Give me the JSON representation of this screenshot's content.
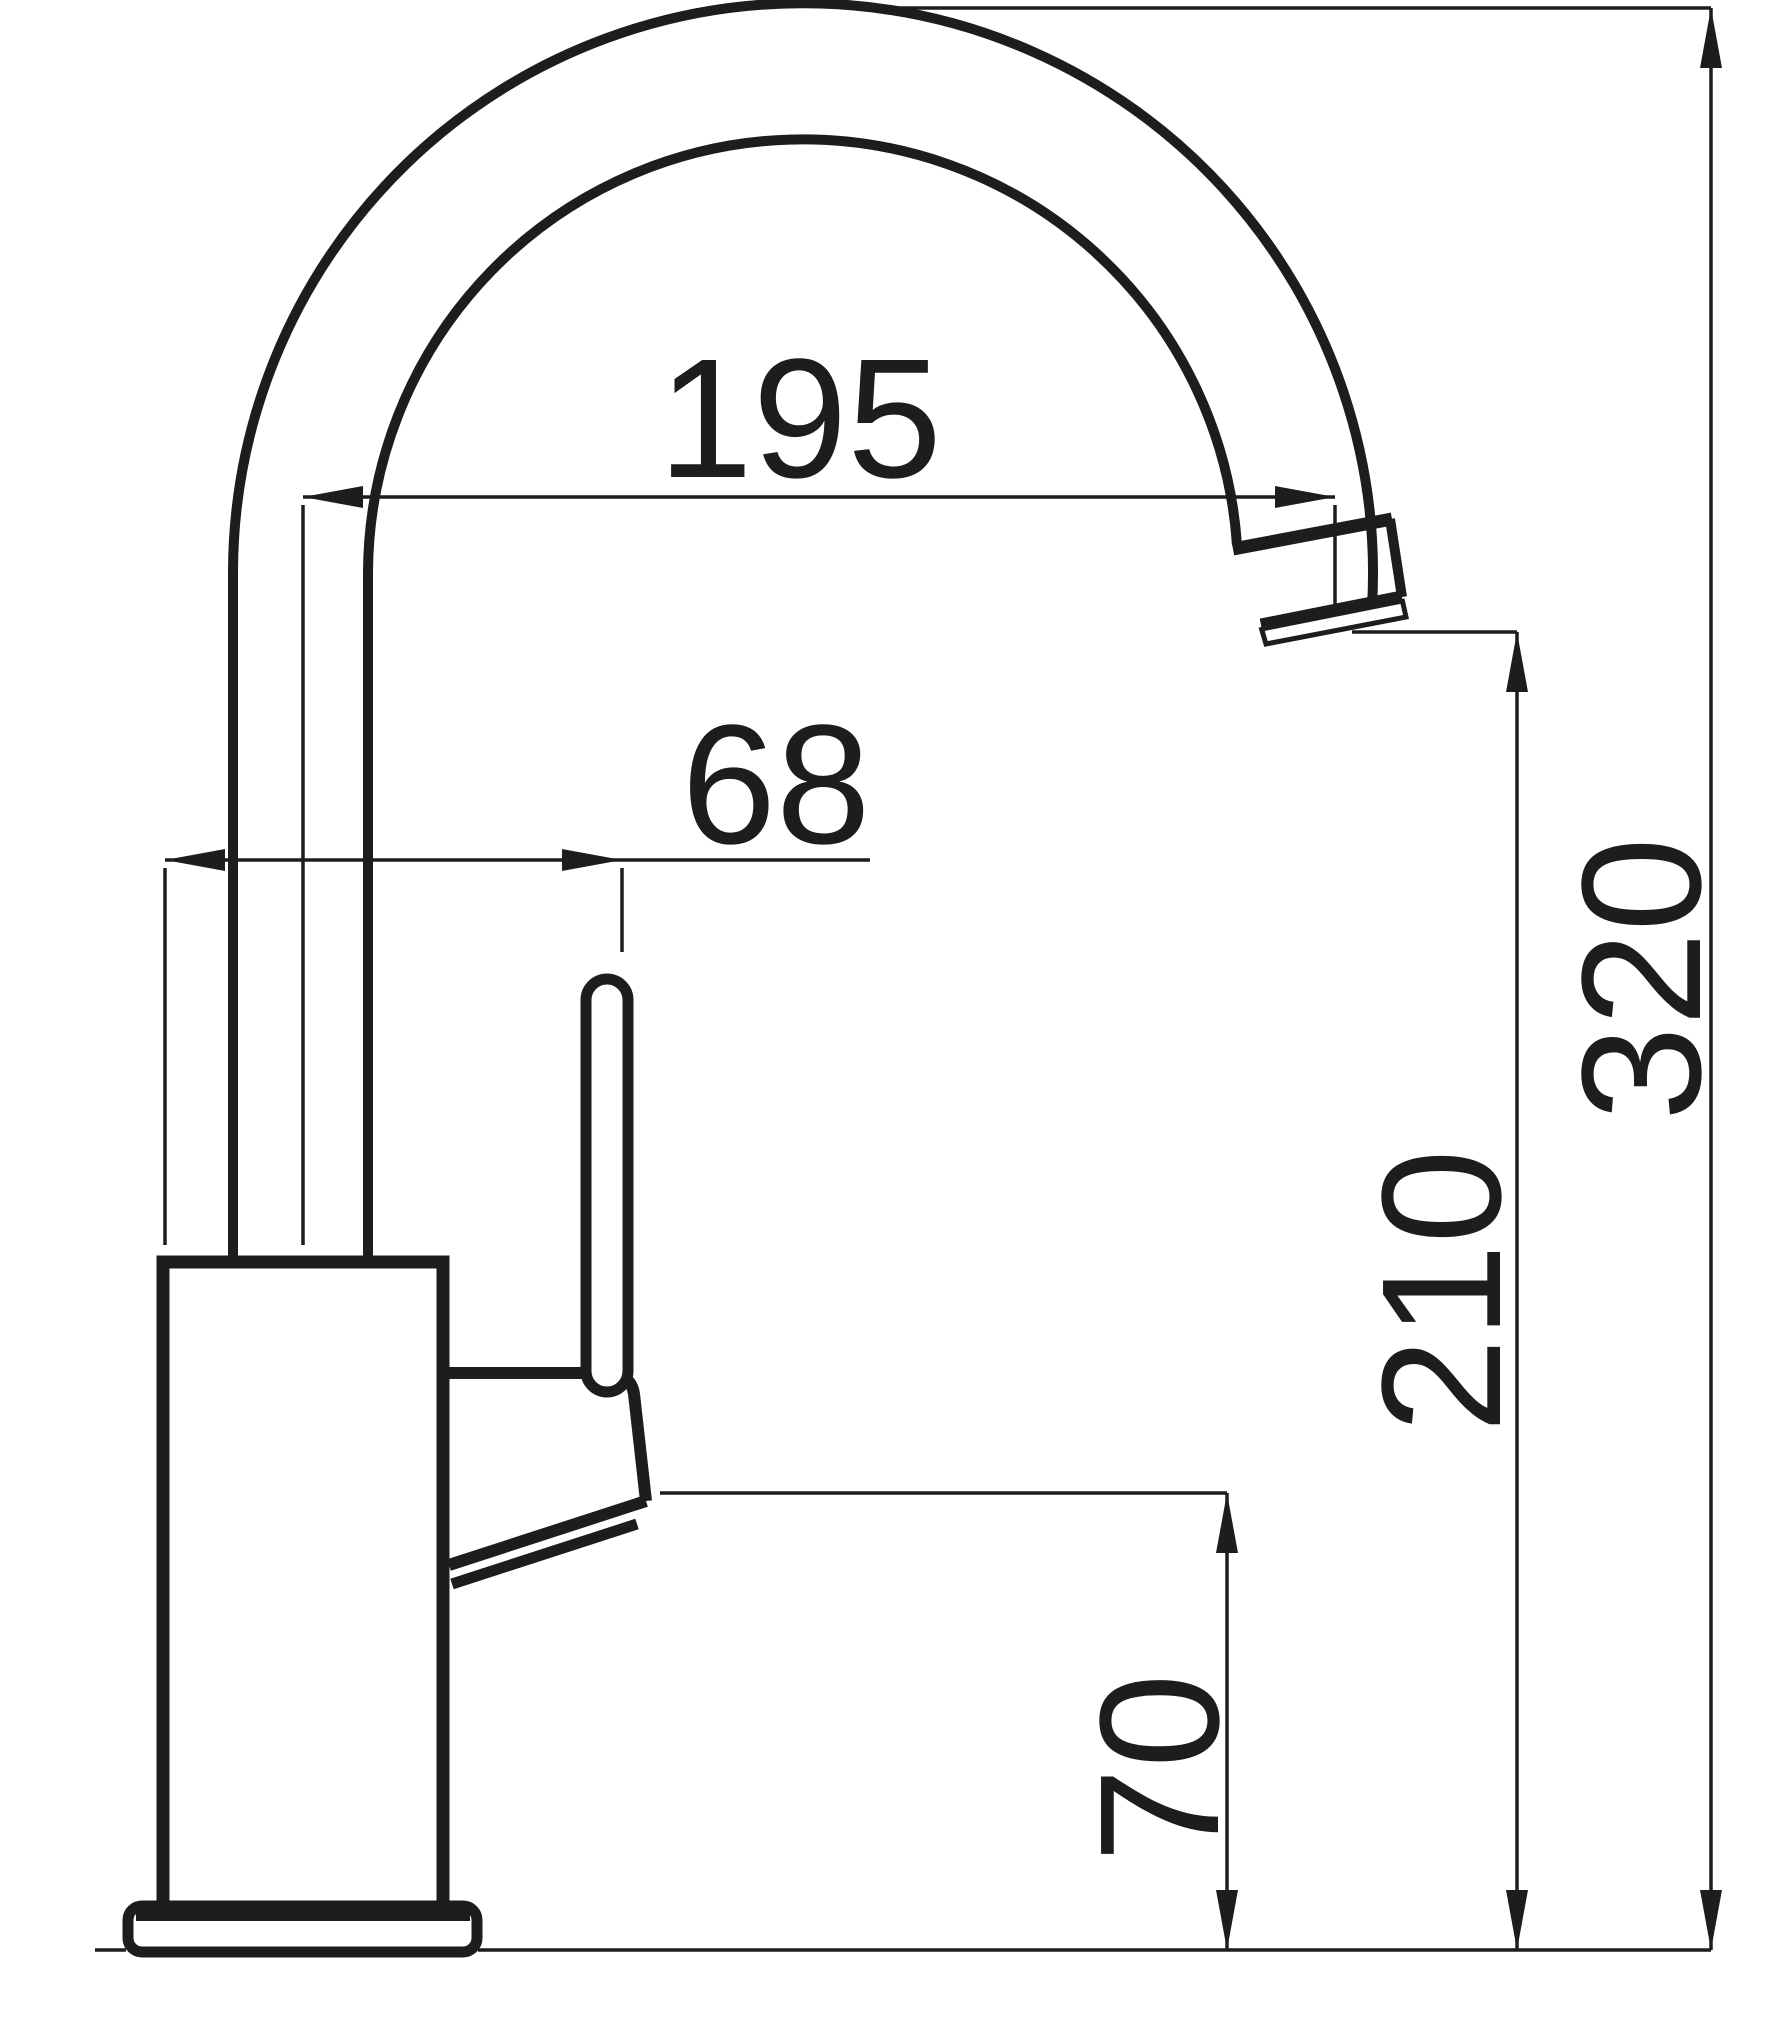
{
  "colors": {
    "ink": "#1d1d1b",
    "paper": "#ffffff"
  },
  "dimensions": {
    "spout_reach": "195",
    "handle_offset": "68",
    "total_height": "320",
    "outlet_height": "210",
    "base_height": "70"
  }
}
